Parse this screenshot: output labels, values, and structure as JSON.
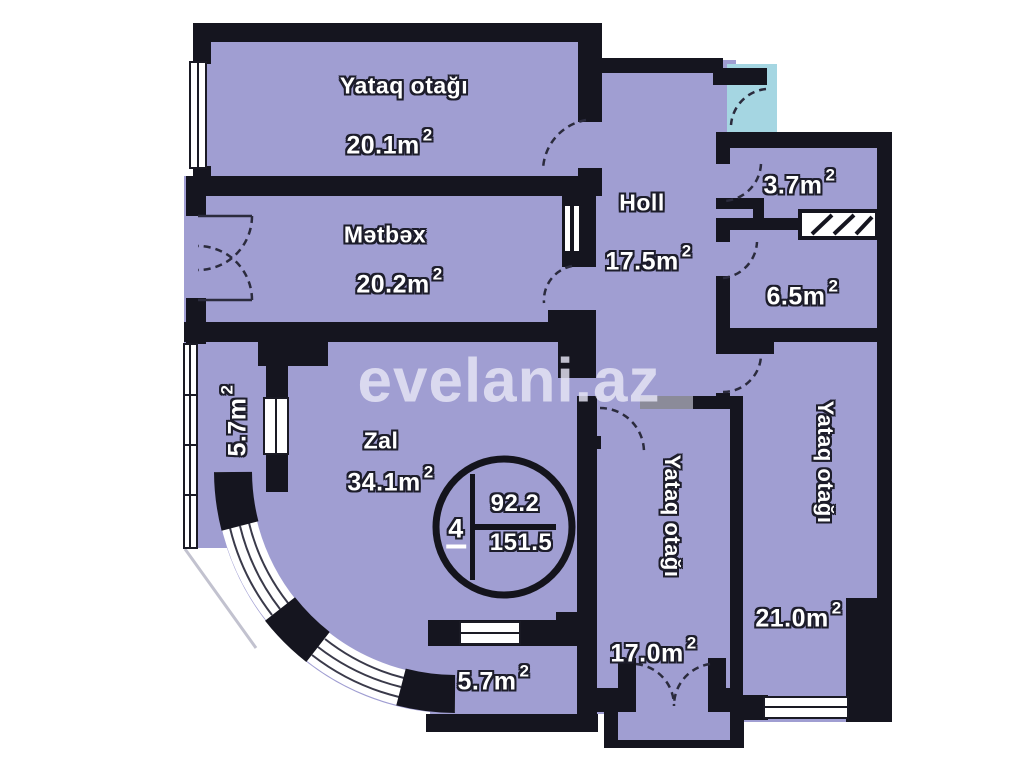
{
  "watermark": "evelani.az",
  "summary": {
    "rooms_count": "4",
    "living_area": "92.2",
    "total_area": "151.5"
  },
  "rooms": [
    {
      "id": "bedroom-top",
      "name": "Yataq otağı",
      "area": "20.1m",
      "sup": "2"
    },
    {
      "id": "kitchen",
      "name": "Mətbəx",
      "area": "20.2m",
      "sup": "2"
    },
    {
      "id": "hall",
      "name": "Holl",
      "area": "17.5m",
      "sup": "2"
    },
    {
      "id": "wc",
      "name": "",
      "area": "3.7m",
      "sup": "2"
    },
    {
      "id": "bathroom",
      "name": "",
      "area": "6.5m",
      "sup": "2"
    },
    {
      "id": "living-room",
      "name": "Zal",
      "area": "34.1m",
      "sup": "2"
    },
    {
      "id": "balcony-left",
      "name": "",
      "area": "5.7m",
      "sup": "2"
    },
    {
      "id": "balcony-bottom",
      "name": "",
      "area": "5.7m",
      "sup": "2"
    },
    {
      "id": "bedroom-middle",
      "name": "Yataq otağı",
      "area": "17.0m",
      "sup": "2"
    },
    {
      "id": "bedroom-right",
      "name": "Yataq otağı",
      "area": "21.0m",
      "sup": "2"
    }
  ],
  "colors": {
    "room_fill": "#a09ed2",
    "wall": "#15151f",
    "balcony_fill": "#a5d6e2",
    "label_text": "#ffffff",
    "watermark_text": "rgba(230,229,245,0.82)"
  }
}
